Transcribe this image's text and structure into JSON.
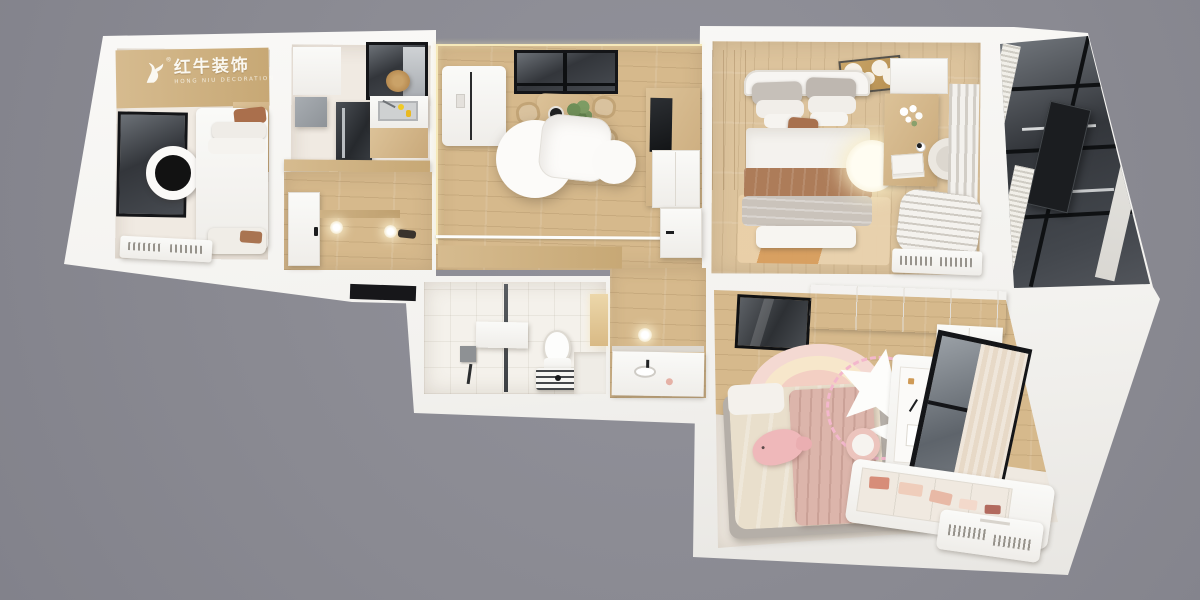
{
  "scene": {
    "kind": "3d-floorplan-top-down-render",
    "description": "Photorealistic top-down 3D render of a two-bedroom apartment floor plan on a gray backdrop",
    "background_color": "#8a8a92"
  },
  "watermark": {
    "brand_cn": "红牛装饰",
    "brand_en": "HONG NIU DECORATION",
    "registered_mark": "®"
  },
  "palette": {
    "outer_wall_white": "#f7f6f3",
    "inner_wall_cream": "#f0eae2",
    "wood_cabinet": "#d2b486",
    "wood_floor": "#d6b98c",
    "dark_glass": "#33363b",
    "bed_linen_white": "#f4f1ec",
    "blanket_brown": "#ad7c59",
    "kids_pink": "#efc6bf",
    "lamp_glow": "#fdf4d9",
    "gray_tile": "#b9b5b0"
  },
  "rooms": [
    {
      "id": "bedroom-secondary",
      "furniture": [
        "logo-headboard-wall",
        "dark-wall-panel",
        "round-ceiling-lamp",
        "single-bed",
        "pillows",
        "floor-cushions",
        "radiator"
      ]
    },
    {
      "id": "kitchen",
      "furniture": [
        "window",
        "wall-cabinet",
        "appliance-column",
        "sink-counter",
        "dish-soap-bottles",
        "wood-counter",
        "rattan-pendant",
        "gray-tile-floor"
      ]
    },
    {
      "id": "entry-hall",
      "furniture": [
        "entry-door",
        "wall-shelf",
        "ceiling-lamps",
        "shoes"
      ]
    },
    {
      "id": "living-dining",
      "furniture": [
        "refrigerator",
        "window",
        "dining-table",
        "rattan-chairs",
        "plant",
        "cloud-pendant-lamp",
        "tv-sideboard",
        "television",
        "lower-cabinet",
        "floor-track"
      ]
    },
    {
      "id": "bedroom-master",
      "furniture": [
        "wardrobe",
        "carved-ceiling-medallion",
        "double-bed",
        "brown-throw-blanket",
        "round-glow-lamp",
        "vanity-desk",
        "flower-vase",
        "round-chair",
        "curtains",
        "area-rug",
        "foot-bench",
        "striped-duvet",
        "radiator"
      ]
    },
    {
      "id": "balcony",
      "furniture": [
        "glazed-window-wall",
        "black-metal-shelf",
        "dark-panel",
        "curtain-fringe",
        "marble-sill"
      ]
    },
    {
      "id": "bathroom",
      "furniture": [
        "glass-partition",
        "shower-screen-panel",
        "shower-mixer",
        "toilet",
        "towel-radiator",
        "lit-niche",
        "step"
      ]
    },
    {
      "id": "hallway",
      "furniture": [
        "interior-door",
        "wall-lamp",
        "vanity-counter",
        "basin",
        "pink-cup"
      ]
    },
    {
      "id": "bedroom-kids",
      "furniture": [
        "mirror-wardrobe",
        "overhead-cabinets",
        "rainbow-rug",
        "kids-bed",
        "pink-blanket",
        "whale-plush",
        "star-decor-lamp",
        "neon-squiggle",
        "desk-pegboard",
        "desk-chair",
        "window-with-curtain",
        "toy-storage-bench",
        "radiator"
      ]
    }
  ]
}
